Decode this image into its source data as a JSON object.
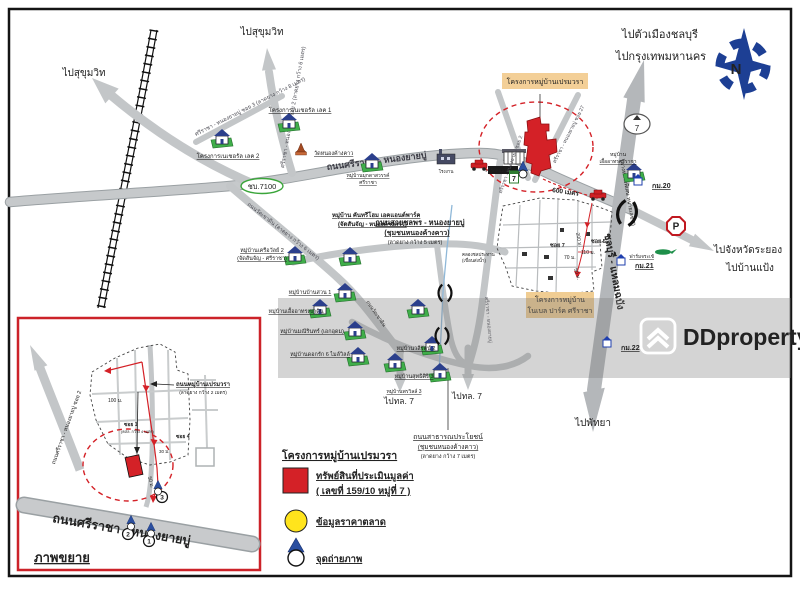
{
  "dir": {
    "sukhumvit_nw": "ไปสุขุมวิท",
    "sukhumvit_n": "ไปสุขุมวิท",
    "chonburi": "ไปตัวเมืองชลบุรี",
    "bangkok": "ไปกรุงเทพมหานคร",
    "rayong": "ไปจังหวัดระยอง",
    "ban_paeng": "ไปบ้านแป้ง",
    "pattaya": "ไปพัทยา",
    "tl7_left": "ไปทล. 7",
    "tl7_right": "ไปทล. 7"
  },
  "roads": {
    "main": "ถนนศรีราชา - หนองยายบู่",
    "soi3": "ศรีราชา - หนองยายบู่ ซอย 3 (ลาดยาง กว้าง 8 เมตร)",
    "soi2": "ศรีราชา - หนองยายบู่ ซอย 2 (ลาดยาง กว้าง 6 เมตร)",
    "soi2b": "ศรีราชา - หนองยายบู่ ซอย 2",
    "soi27": "ศรีราชา - หนองยายบู่ ซอย 27",
    "soi_south": "ศรีราชา - หนองยายบู่",
    "wat_khao_din": "ถนนวัดเขาดิน (ลาดยาง กว้าง 6 เมตร)",
    "wat_khao_din2": "ถนนวัดเขาดิน",
    "route_no": "ชบ.7100",
    "motorway": "ชลบุรี - แหลมฉบัง",
    "motorway_note": "(ทางหลวงพิเศษ หมายเลข 7)",
    "highway_no": "7",
    "cluster": [
      "ถนนสายชลพร - หนองยายบู่",
      "(ชุมชนหนองค้างคาว)",
      "(ลาดยาง กว้าง 5 เมตร)"
    ],
    "south": [
      "ถนนสาธารณประโยชน์",
      "(ชุมชนหนองค้างคาว)",
      "(ลาดยาง กว้าง 7 เมตร)"
    ]
  },
  "project": {
    "banner": "โครงการหมู่บ้านเปรมวรา",
    "noble": [
      "โครงการหมู่บ้าน",
      "โนเบล ปาร์ค ศรีราชา"
    ],
    "school": "รร.วัดหนองค้างคาว",
    "p": "P"
  },
  "compass": {
    "n": "N"
  },
  "watermark": {
    "brand": "DDproperty"
  },
  "legend": {
    "title": "โครงการหมู่บ้านเปรมวรา",
    "asset": "ทรัพย์สินที่ประเมินมูลค่า",
    "asset2": "( เลขที่ 159/10 หมู่ที่ 7 )",
    "market": "ข้อมูลราคาตลาด",
    "photo": "จุดถ่ายภาพ"
  },
  "inset": {
    "title": "ภาพขยาย",
    "road": "ถนนศรีราชา - หนองยายบู่",
    "side_road": "ถนนศรีราชา - หนองยายบู่ ซอย 2",
    "prem_road": "ถนนหมู่บ้านเปรมวรา",
    "prem_note": "(ลาดยาง กว้าง 2 เมตร)",
    "p1": "1",
    "p2": "2",
    "p3": "3"
  },
  "colors": {
    "red": "#d42127",
    "road": "#c3c6c8",
    "orange_bg": "#f3cf97",
    "yellow": "#ffe41c",
    "blue": "#1f3fae",
    "green": "#3aa53a"
  },
  "map": {
    "icons": [
      {
        "t": "village",
        "x": 289,
        "y": 122
      },
      {
        "t": "village",
        "x": 222,
        "y": 138
      },
      {
        "t": "temple",
        "x": 301,
        "y": 152
      },
      {
        "t": "village",
        "x": 372,
        "y": 162
      },
      {
        "t": "village",
        "x": 634,
        "y": 172
      },
      {
        "t": "village",
        "x": 295,
        "y": 255
      },
      {
        "t": "village",
        "x": 350,
        "y": 256
      },
      {
        "t": "village",
        "x": 345,
        "y": 292
      },
      {
        "t": "village",
        "x": 320,
        "y": 308
      },
      {
        "t": "village",
        "x": 355,
        "y": 330
      },
      {
        "t": "village",
        "x": 358,
        "y": 356
      },
      {
        "t": "village",
        "x": 418,
        "y": 308
      },
      {
        "t": "village",
        "x": 432,
        "y": 345
      },
      {
        "t": "village",
        "x": 440,
        "y": 372
      },
      {
        "t": "village",
        "x": 395,
        "y": 362
      },
      {
        "t": "factory",
        "x": 446,
        "y": 158
      },
      {
        "t": "car",
        "x": 479,
        "y": 166
      },
      {
        "t": "car",
        "x": 598,
        "y": 196
      },
      {
        "t": "croc",
        "x": 663,
        "y": 252
      },
      {
        "t": "seven",
        "x": 514,
        "y": 177
      },
      {
        "t": "pin",
        "x": 523,
        "y": 170,
        "s": 0.8
      },
      {
        "t": "bridge",
        "x": 627,
        "y": 213,
        "r": 12
      },
      {
        "t": "bridge",
        "x": 445,
        "y": 293,
        "s": 0.7
      },
      {
        "t": "bridge",
        "x": 442,
        "y": 336,
        "s": 0.7
      },
      {
        "t": "km",
        "x": 638,
        "y": 180
      },
      {
        "t": "km",
        "x": 621,
        "y": 260
      },
      {
        "t": "km",
        "x": 607,
        "y": 342
      },
      {
        "t": "pin",
        "x": 158,
        "y": 488,
        "s": 0.7
      },
      {
        "t": "pin",
        "x": 131,
        "y": 523,
        "s": 0.7
      },
      {
        "t": "pin",
        "x": 151,
        "y": 530,
        "s": 0.7
      }
    ],
    "labels": [
      {
        "t": "โครงการเนเชอรัล เลค 1",
        "x": 300,
        "y": 112,
        "s": 6,
        "a": "middle",
        "u": 1,
        "n": "village-label"
      },
      {
        "t": "โครงการเนเชอรัล เลค 2",
        "x": 228,
        "y": 158,
        "s": 6,
        "a": "middle",
        "u": 1,
        "n": "village-label"
      },
      {
        "t": "วัดหนองค้างคาว",
        "x": 314,
        "y": 155,
        "s": 5.5,
        "c": "#6b4423",
        "u": 1,
        "n": "temple-label"
      },
      {
        "t": "หมู่บ้านมุกดาสวรรค์",
        "x": 368,
        "y": 177,
        "s": 5,
        "a": "middle",
        "u": 1,
        "n": "village-label"
      },
      {
        "t": "ศรีราชา",
        "x": 368,
        "y": 184,
        "s": 5,
        "a": "middle",
        "u": 1,
        "n": "village-label"
      },
      {
        "t": "หมู่บ้าน",
        "x": 618,
        "y": 156,
        "s": 5,
        "a": "middle",
        "n": "village-label"
      },
      {
        "t": "เอื้ออาทรศรีราชา",
        "x": 618,
        "y": 163,
        "s": 5,
        "a": "middle",
        "u": 1,
        "n": "village-label"
      },
      {
        "t": "หมู่บ้าน คันทรีโฮม เอคแอนด์พาร์ค",
        "x": 332,
        "y": 217,
        "s": 6,
        "u": 1,
        "b": 1,
        "n": "village-label"
      },
      {
        "t": "(จัดสันจัญ - หนองค้างคาว)",
        "x": 338,
        "y": 226,
        "s": 6,
        "u": 1,
        "b": 1,
        "n": "village-label"
      },
      {
        "t": "หมู่บ้านเครือวัลย์ 2",
        "x": 262,
        "y": 252,
        "s": 5.5,
        "a": "middle",
        "u": 1,
        "n": "village-label"
      },
      {
        "t": "(จัดสันจัญ - ศรีราชา)",
        "x": 262,
        "y": 260,
        "s": 5.5,
        "a": "middle",
        "u": 1,
        "n": "village-label"
      },
      {
        "t": "หมู่บ้านบ้านสวน 1",
        "x": 310,
        "y": 294,
        "s": 5.5,
        "a": "middle",
        "u": 1,
        "n": "village-label"
      },
      {
        "t": "หมู่บ้านเอื้ออาทรเขาดิน",
        "x": 296,
        "y": 313,
        "s": 5.5,
        "a": "middle",
        "u": 1,
        "n": "village-label"
      },
      {
        "t": "หมู่บ้านมณีรินทร์ (เอกอุดม)",
        "x": 312,
        "y": 333,
        "s": 5.5,
        "a": "middle",
        "u": 1,
        "n": "village-label"
      },
      {
        "t": "หมู่บ้านดอกรัก 6 ไมล์วิลล์",
        "x": 320,
        "y": 356,
        "s": 5.5,
        "a": "middle",
        "u": 1,
        "n": "village-label"
      },
      {
        "t": "หมู่บ้านวลีรัตน์ 2",
        "x": 416,
        "y": 350,
        "s": 5.5,
        "a": "middle",
        "u": 1,
        "n": "village-label"
      },
      {
        "t": "หมู่บ้านสุทธิศิริ 3",
        "x": 414,
        "y": 378,
        "s": 5.5,
        "a": "middle",
        "u": 1,
        "n": "village-label"
      },
      {
        "t": "หมู่บ้านพรวิลล์ 3",
        "x": 404,
        "y": 393,
        "s": 5,
        "a": "middle",
        "u": 1,
        "n": "village-label"
      },
      {
        "t": "โรงงาน",
        "x": 446,
        "y": 173,
        "s": 4.5,
        "a": "middle",
        "c": "#555",
        "n": "factory-label"
      },
      {
        "t": "ฟาร์มจระเข้",
        "x": 654,
        "y": 258,
        "s": 4.8,
        "a": "end",
        "c": "#444",
        "u": 1,
        "n": "farm-label"
      },
      {
        "t": "ถนนวัดเขาดิน",
        "x": 366,
        "y": 302,
        "s": 5,
        "r": 55,
        "c": "#4a4a52",
        "n": "road-label"
      },
      {
        "t": "คลองชลประทาน",
        "x": 462,
        "y": 256,
        "s": 4.5,
        "c": "#4a7ba6",
        "n": "canal-label"
      },
      {
        "t": "(เขื่อนส่งน้ำ)",
        "x": 462,
        "y": 262,
        "s": 4.5,
        "c": "#4a7ba6",
        "n": "canal-label"
      },
      {
        "t": "กม.20",
        "x": 652,
        "y": 188,
        "s": 7,
        "c": "#1f3fae",
        "u": 1,
        "b": 1,
        "n": "km-marker-label"
      },
      {
        "t": "กม.21",
        "x": 635,
        "y": 268,
        "s": 7,
        "c": "#1f3fae",
        "u": 1,
        "b": 1,
        "n": "km-marker-label"
      },
      {
        "t": "กม.22",
        "x": 621,
        "y": 350,
        "s": 7,
        "c": "#1f3fae",
        "u": 1,
        "b": 1,
        "n": "km-marker-label"
      },
      {
        "t": "600 เมตร",
        "x": 552,
        "y": 192,
        "s": 6.5,
        "c": "#d42127",
        "b": 1,
        "r": 8,
        "n": "distance-label"
      },
      {
        "t": "200 ม.",
        "x": 576,
        "y": 233,
        "s": 5,
        "c": "#d42127",
        "r": 78,
        "n": "distance-label"
      },
      {
        "t": "110 ม.",
        "x": 581,
        "y": 254,
        "s": 5,
        "c": "#d42127",
        "n": "distance-label"
      },
      {
        "t": "70 ม.",
        "x": 564,
        "y": 259,
        "s": 5,
        "c": "#d42127",
        "n": "distance-label"
      },
      {
        "t": "50 ม.",
        "x": 574,
        "y": 269,
        "s": 5,
        "c": "#d42127",
        "r": 72,
        "n": "distance-label"
      },
      {
        "t": "ซอย 7",
        "x": 550,
        "y": 247,
        "s": 5.5,
        "b": 1,
        "n": "soi-label"
      },
      {
        "t": "ซอย 5",
        "x": 591,
        "y": 243,
        "s": 5.5,
        "b": 1,
        "n": "soi-label"
      },
      {
        "t": "100 ม.",
        "x": 108,
        "y": 402,
        "s": 5,
        "c": "#d42127",
        "n": "distance-label"
      },
      {
        "t": "ซอย 1",
        "x": 124,
        "y": 426,
        "s": 5,
        "c": "#8c1418",
        "b": 1,
        "n": "soi-label"
      },
      {
        "t": "(คสล. กว้าง 4 เมตร)",
        "x": 121,
        "y": 433,
        "s": 3.8,
        "c": "#777",
        "n": "soi-note"
      },
      {
        "t": "ซอย 4",
        "x": 176,
        "y": 438,
        "s": 5,
        "c": "#8c1418",
        "b": 1,
        "n": "soi-label"
      },
      {
        "t": "50 ม.",
        "x": 148,
        "y": 477,
        "s": 5,
        "c": "#d42127",
        "r": 75,
        "n": "distance-label"
      },
      {
        "t": "30 ม.",
        "x": 159,
        "y": 453,
        "s": 4.5,
        "c": "#d42127",
        "n": "distance-label"
      }
    ]
  }
}
